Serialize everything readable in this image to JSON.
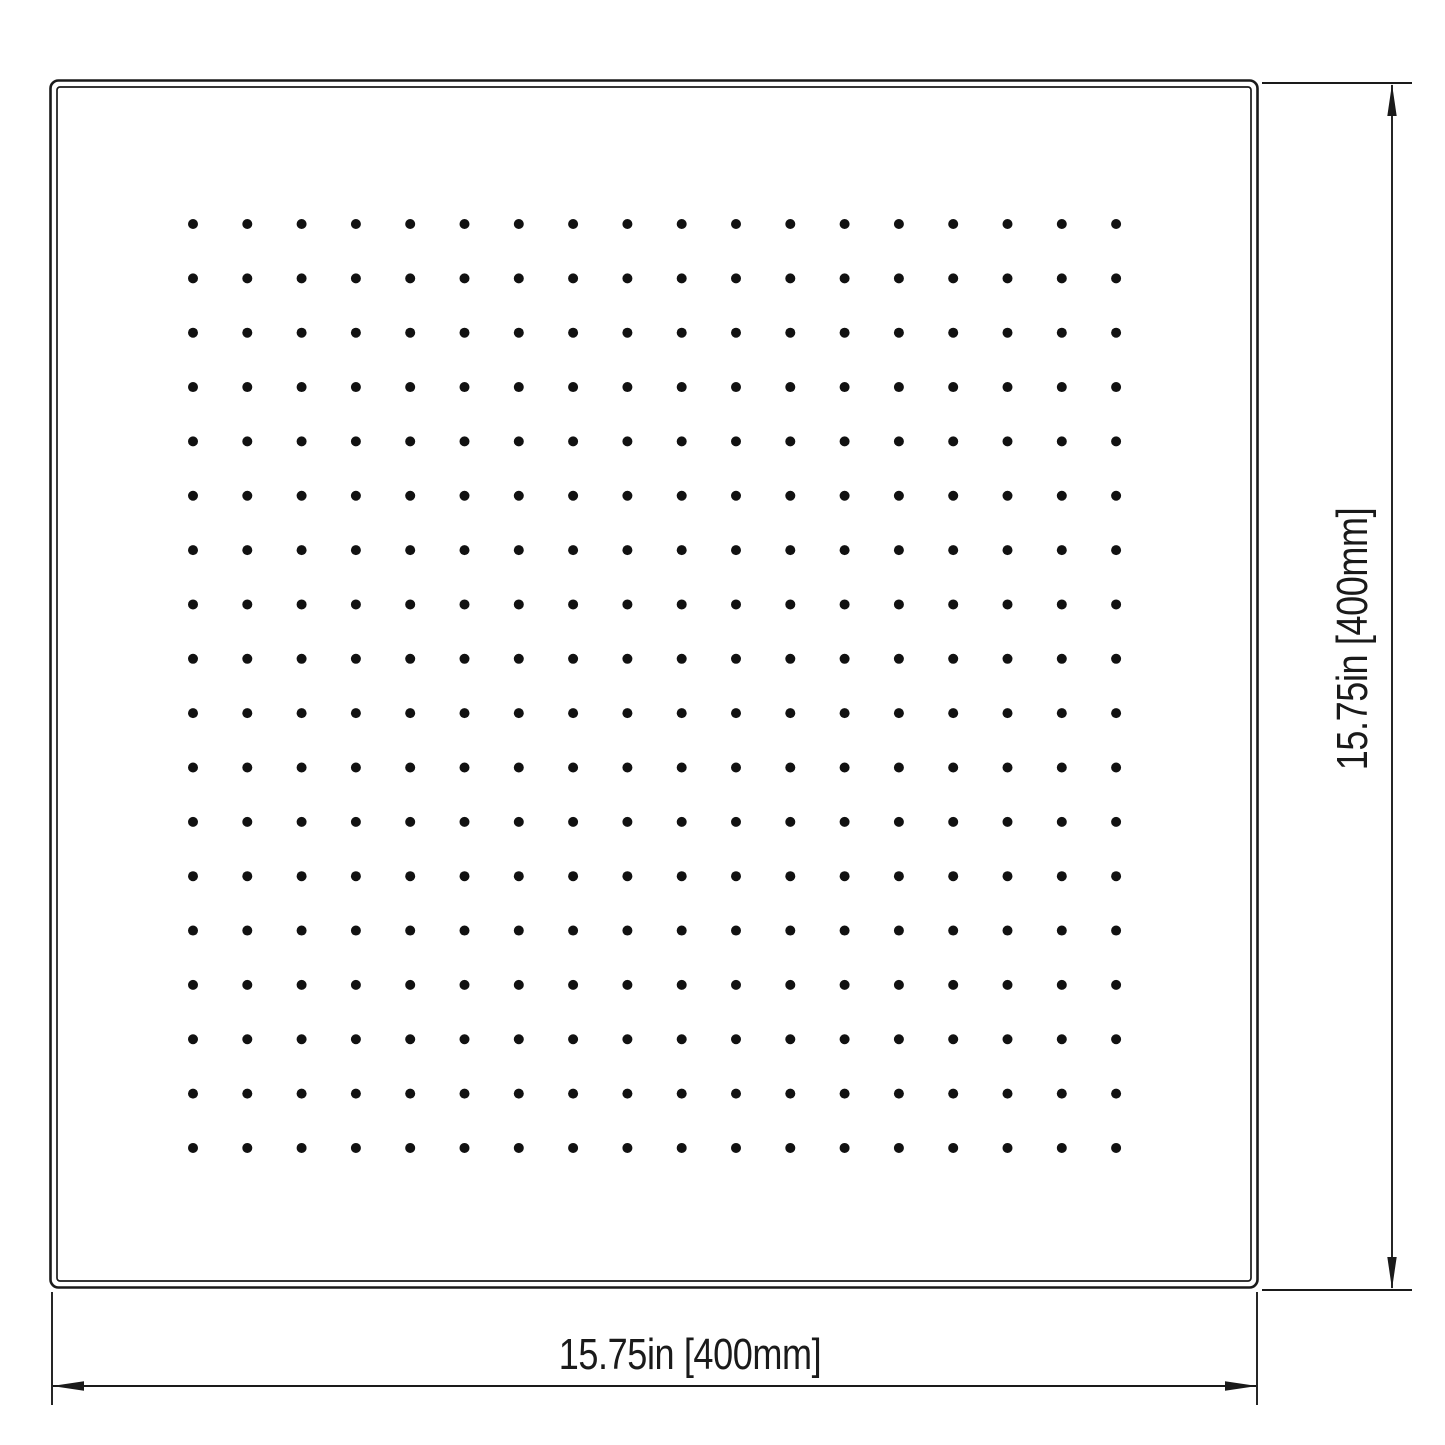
{
  "page": {
    "background_color": "#ffffff",
    "line_color": "#1a1a1a"
  },
  "drawing": {
    "type": "technical-dimension-drawing",
    "subject": "square rain shower head face, top view with nozzle pattern",
    "plate": {
      "outer": {
        "x": 50,
        "y": 80,
        "width": 1208,
        "height": 1208,
        "corner_radius": 8
      },
      "inner_inset": 6.5
    },
    "nozzle_grid": {
      "rows": 18,
      "cols": 18,
      "start_x": 193,
      "start_y": 224,
      "spacing_x": 54.3,
      "spacing_y": 54.35,
      "dot_radius": 5,
      "dot_color": "#111111"
    },
    "dimensions": {
      "width": {
        "label": "15.75in [400mm]"
      },
      "height": {
        "label": "15.75in [400mm]"
      }
    }
  }
}
